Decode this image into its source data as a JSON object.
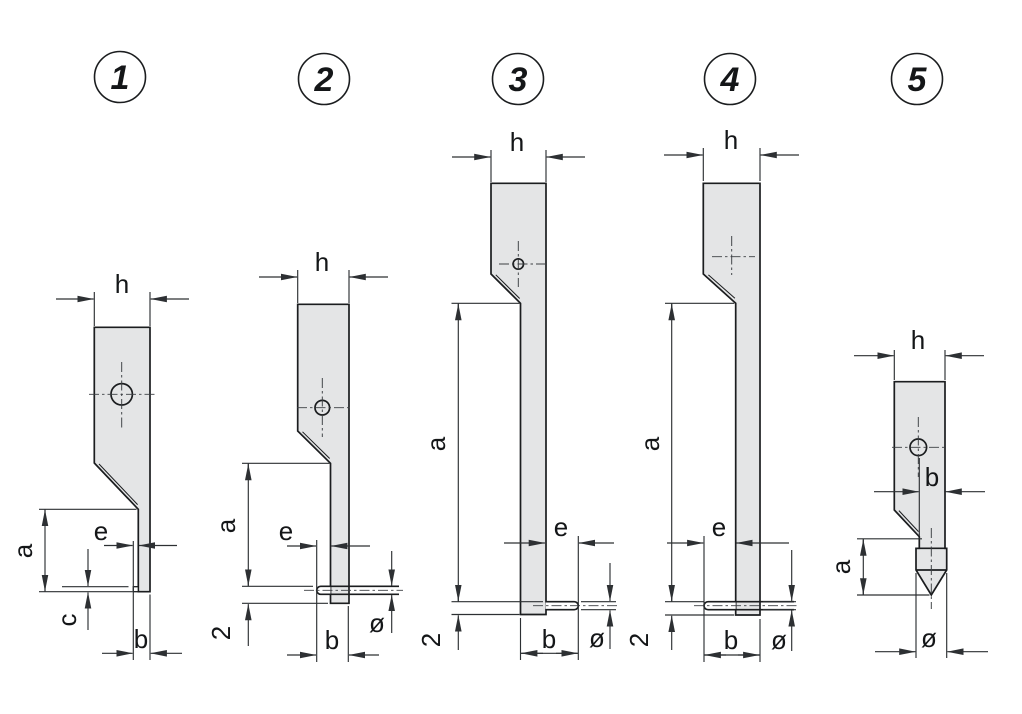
{
  "figures": [
    {
      "number": "1",
      "dims": {
        "h": "h",
        "a": "a",
        "e": "e",
        "c": "c",
        "b": "b"
      }
    },
    {
      "number": "2",
      "dims": {
        "h": "h",
        "a": "a",
        "e": "e",
        "depth": "2",
        "b": "b",
        "dia": "ø"
      }
    },
    {
      "number": "3",
      "dims": {
        "h": "h",
        "a": "a",
        "e": "e",
        "depth": "2",
        "b": "b",
        "dia": "ø"
      }
    },
    {
      "number": "4",
      "dims": {
        "h": "h",
        "a": "a",
        "e": "e",
        "depth": "2",
        "b": "b",
        "dia": "ø"
      }
    },
    {
      "number": "5",
      "dims": {
        "h": "h",
        "b": "b",
        "a": "a",
        "dia": "ø"
      }
    }
  ],
  "colors": {
    "body_fill": "#e4e5e6",
    "outline": "#1b1d1f",
    "dim_line": "#2d3033",
    "center_line": "#3b3e42",
    "label": "#141618",
    "background": "#ffffff"
  }
}
